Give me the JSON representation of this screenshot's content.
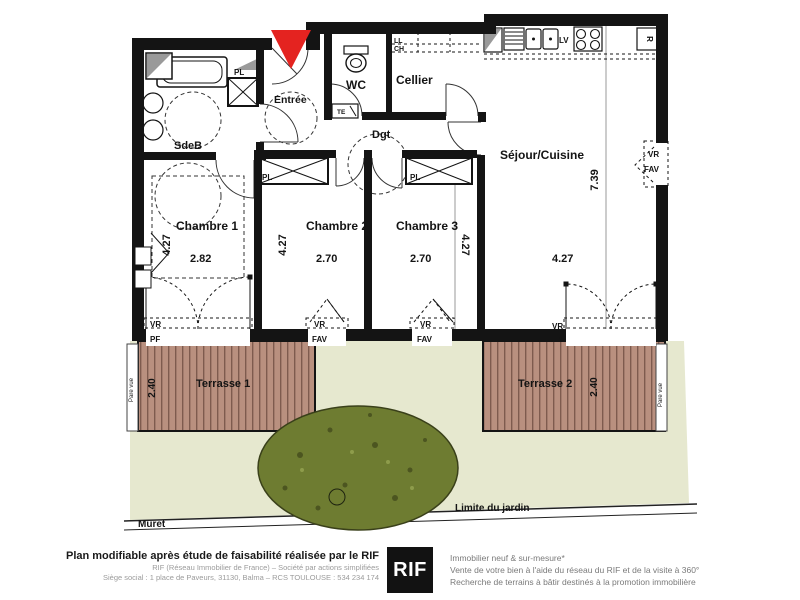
{
  "colors": {
    "wall": "#141414",
    "accent_red": "#e42320",
    "deck": "#b9907f",
    "deck_line": "#7e5b4e",
    "garden": "#e6e8cf",
    "bush": "#6e7c31",
    "bush_dark": "#4c5520",
    "gray_fill": "#9a9a9a"
  },
  "rooms": {
    "sdeb": {
      "label": "SdeB"
    },
    "entree": {
      "label": "Entrée"
    },
    "wc": {
      "label": "WC"
    },
    "cellier": {
      "label": "Cellier"
    },
    "degagement": {
      "label": "Dgt"
    },
    "sejour": {
      "label": "Séjour/Cuisine",
      "width": "4.27",
      "height": "7.39"
    },
    "chambre1": {
      "label": "Chambre 1",
      "width": "2.82",
      "height": "4.27"
    },
    "chambre2": {
      "label": "Chambre 2",
      "width": "2.70",
      "height": "4.27"
    },
    "chambre3": {
      "label": "Chambre 3",
      "width": "2.70",
      "height": "4.27"
    },
    "terrasse1": {
      "label": "Terrasse 1",
      "depth": "2.40"
    },
    "terrasse2": {
      "label": "Terrasse 2",
      "depth": "2.40"
    }
  },
  "closets": {
    "entree_pl": "PL",
    "chambre2_pl": "PL",
    "chambre3_pl": "PL"
  },
  "equipment": {
    "ll": "LL",
    "ch": "CH",
    "te": "TE",
    "lv": "LV",
    "fridge": "R"
  },
  "windows": {
    "chambre1_south": {
      "shutter": "VR",
      "type": "PF"
    },
    "chambre2_south": {
      "shutter": "VR",
      "type": "FAV"
    },
    "chambre3_south": {
      "shutter": "VR",
      "type": "FAV"
    },
    "sejour_south": {
      "shutter": "VR",
      "type": "PF"
    },
    "sejour_east": {
      "shutter": "VR",
      "type": "FAV"
    }
  },
  "garden": {
    "muret": "Muret",
    "limite": "Limite du jardin",
    "pare_vue_left": "Pare vue",
    "pare_vue_right": "Pare vue"
  },
  "footer": {
    "bold_line": "Plan modifiable après étude de faisabilité réalisée par le RIF",
    "small_line1": "RIF (Réseau Immobilier de France) – Société par actions simplifiées",
    "small_line2": "Siège social : 1 place de Paveurs, 31130, Balma – RCS TOULOUSE : 534 234 174",
    "logo": "RIF",
    "right_line1": "Immobilier neuf & sur-mesure*",
    "right_line2": "Vente de votre bien à l'aide du réseau du RIF et de la visite à 360°",
    "right_line3": "Recherche de terrains à bâtir destinés à la promotion immobilière"
  }
}
